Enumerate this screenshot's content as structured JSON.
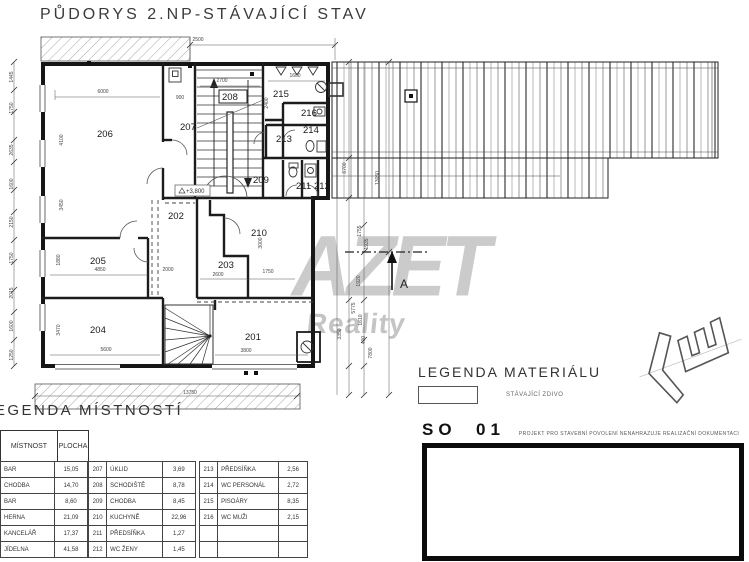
{
  "title": "PŮDORYS 2.NP-STÁVAJÍCÍ STAV",
  "watermark": {
    "line1": "AZET",
    "line2": "Reality",
    "color": "#cbcbcb"
  },
  "section_marker_label": "A",
  "level_label": "+3,800",
  "legend_material": {
    "title": "LEGENDA MATERIÁLU",
    "swatch_label": "STÁVAJÍCÍ ZDIVO"
  },
  "so_block": {
    "code": "SO  01",
    "note": "PROJEKT PRO STAVEBNÍ POVOLENÍ NENAHRAZUJE REALIZAČNÍ DOKUMENTACI"
  },
  "legend_rooms": {
    "title": "LEGENDA MÍSTNOSTÍ",
    "col_headers": [
      "MÍSTNOST",
      "PLOCHA"
    ],
    "groups": [
      {
        "rows": [
          [
            "",
            "BAR",
            "15,05"
          ],
          [
            "",
            "CHODBA",
            "14,70"
          ],
          [
            "",
            "BAR",
            "8,60"
          ],
          [
            "",
            "HERNA",
            "21,09"
          ],
          [
            "",
            "KANCELÁŘ",
            "17,37"
          ],
          [
            "",
            "JÍDELNA",
            "41,58"
          ]
        ],
        "has_num_col": false
      },
      {
        "rows": [
          [
            "207",
            "ÚKLID",
            "3,69"
          ],
          [
            "208",
            "SCHODIŠTĚ",
            "8,78"
          ],
          [
            "209",
            "CHODBA",
            "8,45"
          ],
          [
            "210",
            "KUCHYNĚ",
            "22,96"
          ],
          [
            "211",
            "PŘEDSÍŇKA",
            "1,27"
          ],
          [
            "212",
            "WC ŽENY",
            "1,45"
          ]
        ],
        "has_num_col": true
      },
      {
        "rows": [
          [
            "213",
            "PŘEDSÍŇKA",
            "2,56"
          ],
          [
            "214",
            "WC PERSONÁL",
            "2,72"
          ],
          [
            "215",
            "PISOÁRY",
            "8,35"
          ],
          [
            "216",
            "WC MUŽI",
            "2,15"
          ],
          [
            "",
            "",
            ""
          ],
          [
            "",
            "",
            ""
          ]
        ],
        "has_num_col": true
      }
    ]
  },
  "plan": {
    "rooms": [
      {
        "id": "201",
        "x": 245,
        "y": 340
      },
      {
        "id": "202",
        "x": 168,
        "y": 219
      },
      {
        "id": "203",
        "x": 218,
        "y": 268
      },
      {
        "id": "204",
        "x": 90,
        "y": 333
      },
      {
        "id": "205",
        "x": 90,
        "y": 264
      },
      {
        "id": "206",
        "x": 97,
        "y": 137
      },
      {
        "id": "207",
        "x": 180,
        "y": 130
      },
      {
        "id": "208",
        "x": 222,
        "y": 100,
        "boxed": true
      },
      {
        "id": "209",
        "x": 253,
        "y": 183
      },
      {
        "id": "210",
        "x": 251,
        "y": 236
      },
      {
        "id": "211",
        "x": 296,
        "y": 189
      },
      {
        "id": "212",
        "x": 314,
        "y": 189
      },
      {
        "id": "213",
        "x": 276,
        "y": 142
      },
      {
        "id": "214",
        "x": 303,
        "y": 133
      },
      {
        "id": "215",
        "x": 273,
        "y": 97
      },
      {
        "id": "216",
        "x": 301,
        "y": 116
      }
    ],
    "dims": [
      {
        "t": "2500",
        "x": 198,
        "y": 41,
        "r": 0
      },
      {
        "t": "6000",
        "x": 103,
        "y": 93,
        "r": 0
      },
      {
        "t": "900",
        "x": 180,
        "y": 99,
        "r": 0
      },
      {
        "t": "2700",
        "x": 222,
        "y": 82,
        "r": 0
      },
      {
        "t": "1600",
        "x": 295,
        "y": 77,
        "r": 0
      },
      {
        "t": "2400",
        "x": 268,
        "y": 103,
        "r": -90
      },
      {
        "t": "4100",
        "x": 63,
        "y": 140,
        "r": -90
      },
      {
        "t": "3450",
        "x": 63,
        "y": 205,
        "r": -90
      },
      {
        "t": "1445",
        "x": 13,
        "y": 77,
        "r": -90
      },
      {
        "t": "1750",
        "x": 13,
        "y": 108,
        "r": -90
      },
      {
        "t": "2635",
        "x": 13,
        "y": 150,
        "r": -90
      },
      {
        "t": "1600",
        "x": 13,
        "y": 184,
        "r": -90
      },
      {
        "t": "2150",
        "x": 13,
        "y": 222,
        "r": -90
      },
      {
        "t": "1750",
        "x": 13,
        "y": 258,
        "r": -90
      },
      {
        "t": "2015",
        "x": 13,
        "y": 293,
        "r": -90
      },
      {
        "t": "1600",
        "x": 13,
        "y": 326,
        "r": -90
      },
      {
        "t": "1250",
        "x": 13,
        "y": 355,
        "r": -90
      },
      {
        "t": "4850",
        "x": 100,
        "y": 271,
        "r": 0
      },
      {
        "t": "2000",
        "x": 168,
        "y": 271,
        "r": 0
      },
      {
        "t": "1880",
        "x": 60,
        "y": 260,
        "r": -90
      },
      {
        "t": "5600",
        "x": 106,
        "y": 351,
        "r": 0
      },
      {
        "t": "3470",
        "x": 60,
        "y": 330,
        "r": -90
      },
      {
        "t": "2600",
        "x": 218,
        "y": 276,
        "r": 0
      },
      {
        "t": "1750",
        "x": 268,
        "y": 273,
        "r": 0
      },
      {
        "t": "3000",
        "x": 262,
        "y": 243,
        "r": -90
      },
      {
        "t": "3800",
        "x": 246,
        "y": 352,
        "r": 0
      },
      {
        "t": "3350",
        "x": 341,
        "y": 334,
        "r": -90
      },
      {
        "t": "13750",
        "x": 190,
        "y": 394,
        "r": 0
      },
      {
        "t": "6700",
        "x": 346,
        "y": 168,
        "r": -90
      },
      {
        "t": "13050",
        "x": 379,
        "y": 178,
        "r": -90
      },
      {
        "t": "1755",
        "x": 361,
        "y": 231,
        "r": -90
      },
      {
        "t": "1935",
        "x": 368,
        "y": 244,
        "r": -90
      },
      {
        "t": "1920",
        "x": 360,
        "y": 281,
        "r": -90
      },
      {
        "t": "5775",
        "x": 355,
        "y": 308,
        "r": -90
      },
      {
        "t": "1610",
        "x": 362,
        "y": 320,
        "r": -90
      },
      {
        "t": "400",
        "x": 365,
        "y": 340,
        "r": -90
      },
      {
        "t": "7800",
        "x": 372,
        "y": 353,
        "r": -90
      }
    ]
  }
}
